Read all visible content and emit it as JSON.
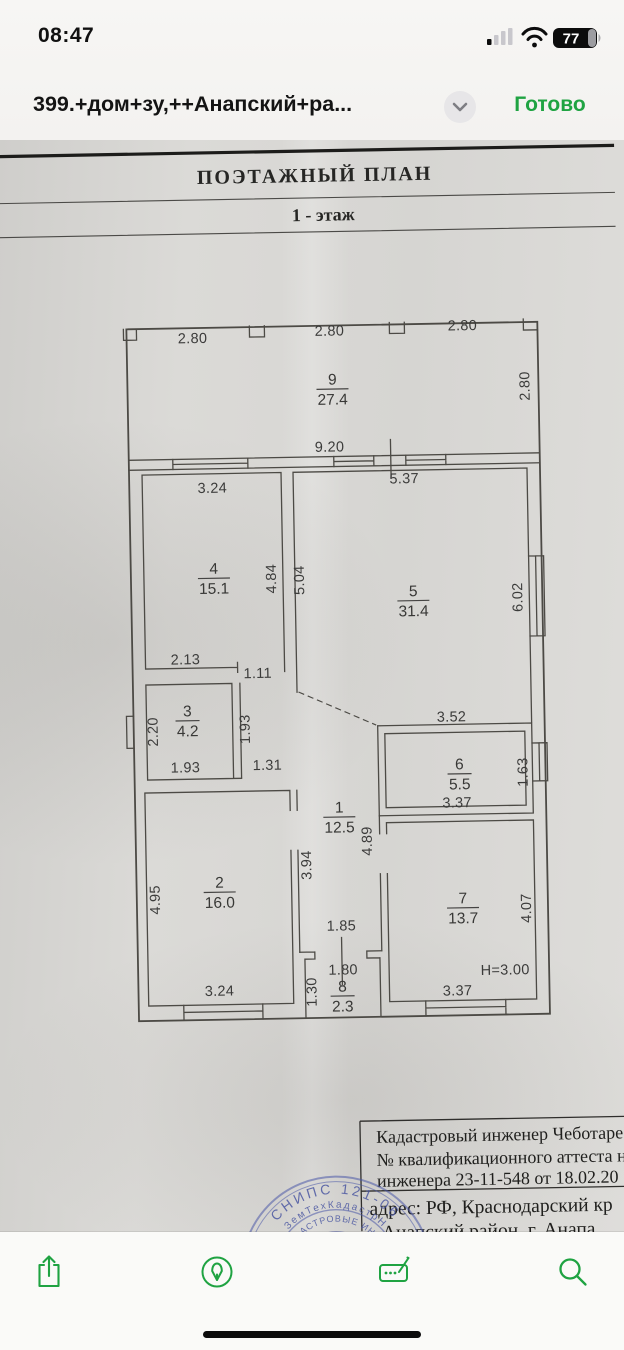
{
  "status_bar": {
    "time": "08:47",
    "battery_percent": "77"
  },
  "title_bar": {
    "title": "399.+дом+зу,++Анапский+ра...",
    "done_label": "Готово"
  },
  "document": {
    "header": {
      "title": "ПОЭТАЖНЫЙ ПЛАН",
      "subtitle": "1 - этаж"
    },
    "plan": {
      "rooms": [
        {
          "n": "9",
          "a": "27.4",
          "x": 338,
          "y": 385
        },
        {
          "n": "4",
          "a": "15.1",
          "x": 216,
          "y": 572
        },
        {
          "n": "5",
          "a": "31.4",
          "x": 415,
          "y": 598
        },
        {
          "n": "3",
          "a": "4.2",
          "x": 187,
          "y": 714
        },
        {
          "n": "1",
          "a": "12.5",
          "x": 337,
          "y": 813
        },
        {
          "n": "6",
          "a": "5.5",
          "x": 458,
          "y": 772
        },
        {
          "n": "2",
          "a": "16.0",
          "x": 216,
          "y": 886
        },
        {
          "n": "7",
          "a": "13.7",
          "x": 459,
          "y": 906
        },
        {
          "n": "8",
          "a": "2.3",
          "x": 337,
          "y": 992
        }
      ],
      "dims": [
        {
          "t": "2.80",
          "x": 199,
          "y": 341
        },
        {
          "t": "2.80",
          "x": 336,
          "y": 336
        },
        {
          "t": "2.80",
          "x": 469,
          "y": 333
        },
        {
          "t": "2.80",
          "x": 535,
          "y": 390,
          "r": 1
        },
        {
          "t": "9.20",
          "x": 334,
          "y": 452
        },
        {
          "t": "5.37",
          "x": 408,
          "y": 485
        },
        {
          "t": "3.24",
          "x": 216,
          "y": 491
        },
        {
          "t": "4.84",
          "x": 278,
          "y": 578,
          "r": 1
        },
        {
          "t": "5.04",
          "x": 306,
          "y": 580,
          "r": 1
        },
        {
          "t": "2.13",
          "x": 186,
          "y": 662
        },
        {
          "t": "1.11",
          "x": 258,
          "y": 677
        },
        {
          "t": "2.20",
          "x": 157,
          "y": 729,
          "r": 1
        },
        {
          "t": "1.93",
          "x": 184,
          "y": 770
        },
        {
          "t": "1.93",
          "x": 249,
          "y": 728,
          "r": 1
        },
        {
          "t": "1.31",
          "x": 266,
          "y": 769
        },
        {
          "t": "6.02",
          "x": 524,
          "y": 601,
          "r": 1
        },
        {
          "t": "3.52",
          "x": 451,
          "y": 724
        },
        {
          "t": "3.37",
          "x": 455,
          "y": 810
        },
        {
          "t": "1.63",
          "x": 526,
          "y": 776,
          "r": 1
        },
        {
          "t": "3.94",
          "x": 308,
          "y": 865,
          "r": 1
        },
        {
          "t": "4.89",
          "x": 369,
          "y": 842,
          "r": 1
        },
        {
          "t": "1.85",
          "x": 337,
          "y": 931
        },
        {
          "t": "1.80",
          "x": 338,
          "y": 975
        },
        {
          "t": "4.95",
          "x": 156,
          "y": 897,
          "r": 1
        },
        {
          "t": "3.24",
          "x": 214,
          "y": 994
        },
        {
          "t": "4.07",
          "x": 527,
          "y": 912,
          "r": 1
        },
        {
          "t": "3.37",
          "x": 452,
          "y": 998
        },
        {
          "t": "Н=3.00",
          "x": 500,
          "y": 978
        },
        {
          "t": "1.30",
          "x": 311,
          "y": 992,
          "r": 1
        }
      ]
    },
    "footer_block": {
      "lines": [
        "Кадастровый инженер Чеботаре",
        "№ квалификационного аттеста н",
        "инженера 23-11-548 от 18.02.20"
      ],
      "lines_below": [
        "адрес: РФ, Краснодарский кр",
        "Анапский район, г. Анапа"
      ]
    },
    "stamp": {
      "ring_text": "СНИПС 121-06",
      "mid_text": "ЗемТехКадастрН",
      "inner_text": "КАДАСТРОВЫЕ ИНЖЕ"
    }
  },
  "toolbar": {
    "icons": [
      "share-icon",
      "markup-icon",
      "fill-sign-icon",
      "search-icon"
    ]
  },
  "colors": {
    "accent_green": "#1fa342",
    "stamp_blue": "#4a58a8"
  }
}
